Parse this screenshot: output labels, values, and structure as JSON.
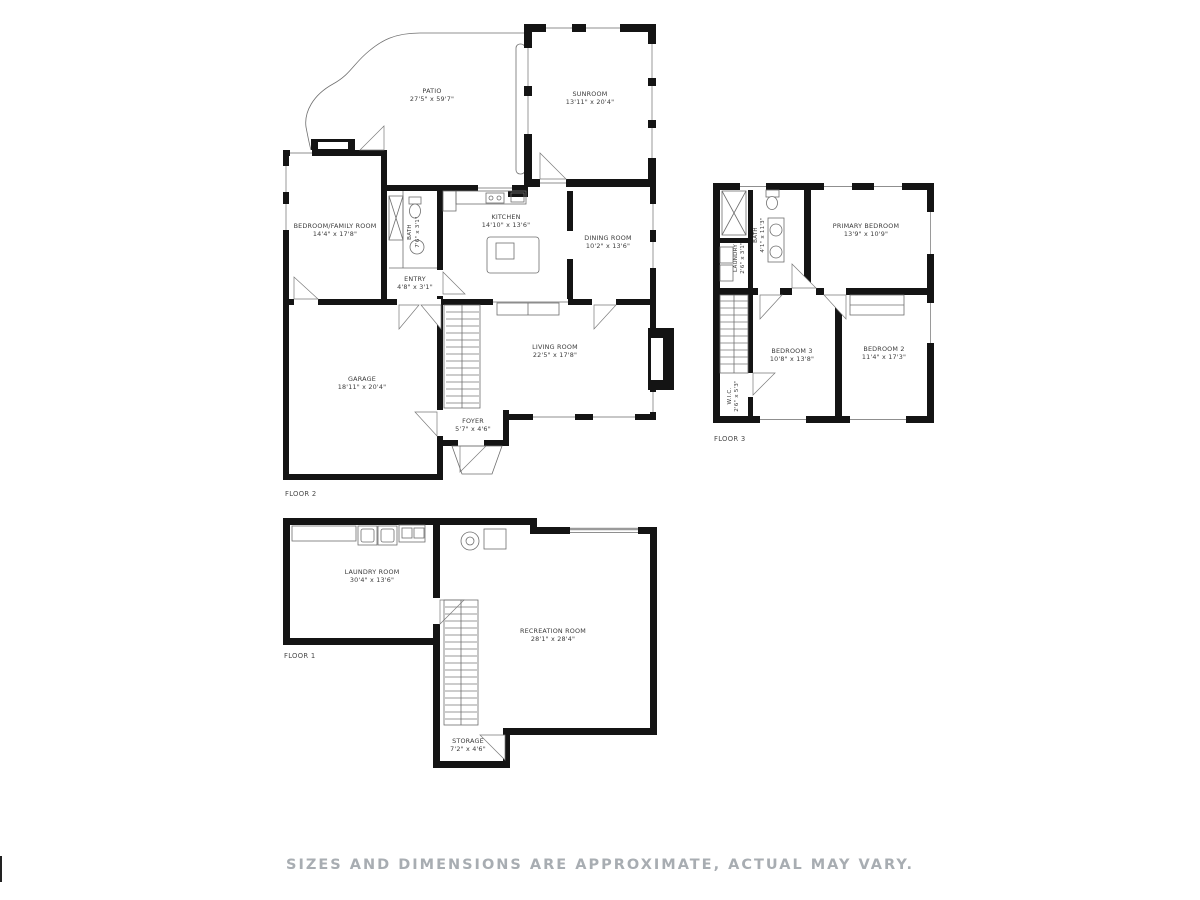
{
  "floor2": {
    "label": "FLOOR 2",
    "rooms": {
      "patio": {
        "name": "PATIO",
        "dims": "27'5\" x 59'7\""
      },
      "sunroom": {
        "name": "SUNROOM",
        "dims": "13'11\" x 20'4\""
      },
      "kitchen": {
        "name": "KITCHEN",
        "dims": "14'10\" x 13'6\""
      },
      "dining_room": {
        "name": "DINING ROOM",
        "dims": "10'2\" x 13'6\""
      },
      "bedroom_family_room": {
        "name": "BEDROOM/FAMILY ROOM",
        "dims": "14'4\" x 17'8\""
      },
      "entry": {
        "name": "ENTRY",
        "dims": "4'8\" x 3'1\""
      },
      "bath": {
        "name": "BATH",
        "dims": "7'6\" x 3'1\""
      },
      "living_room": {
        "name": "LIVING ROOM",
        "dims": "22'5\" x 17'8\""
      },
      "garage": {
        "name": "GARAGE",
        "dims": "18'11\" x 20'4\""
      },
      "foyer": {
        "name": "FOYER",
        "dims": "5'7\" x 4'6\""
      }
    }
  },
  "floor3": {
    "label": "FLOOR 3",
    "rooms": {
      "primary_bedroom": {
        "name": "PRIMARY BEDROOM",
        "dims": "13'9\" x 10'9\""
      },
      "bath": {
        "name": "BATH",
        "dims": "4'1\" x 11'3\""
      },
      "laundry": {
        "name": "LAUNDRY",
        "dims": "2'6\" x 3'1\""
      },
      "bedroom_3": {
        "name": "BEDROOM 3",
        "dims": "10'8\" x 13'8\""
      },
      "bedroom_2": {
        "name": "BEDROOM 2",
        "dims": "11'4\" x 17'3\""
      },
      "wic": {
        "name": "W.I.C.",
        "dims": "2'6\" x 5'3\""
      }
    }
  },
  "floor1": {
    "label": "FLOOR 1",
    "rooms": {
      "laundry_room": {
        "name": "LAUNDRY ROOM",
        "dims": "30'4\" x 13'6\""
      },
      "recreation_room": {
        "name": "RECREATION ROOM",
        "dims": "28'1\" x 28'4\""
      },
      "storage": {
        "name": "STORAGE",
        "dims": "7'2\" x 4'6\""
      }
    }
  },
  "disclaimer": "SIZES AND DIMENSIONS ARE APPROXIMATE, ACTUAL MAY VARY.",
  "colors": {
    "wall": "#141414",
    "thin_line": "#6f6f6f",
    "label": "#3b3b3b",
    "disclaimer": "#a8adb2",
    "background": "#ffffff"
  }
}
